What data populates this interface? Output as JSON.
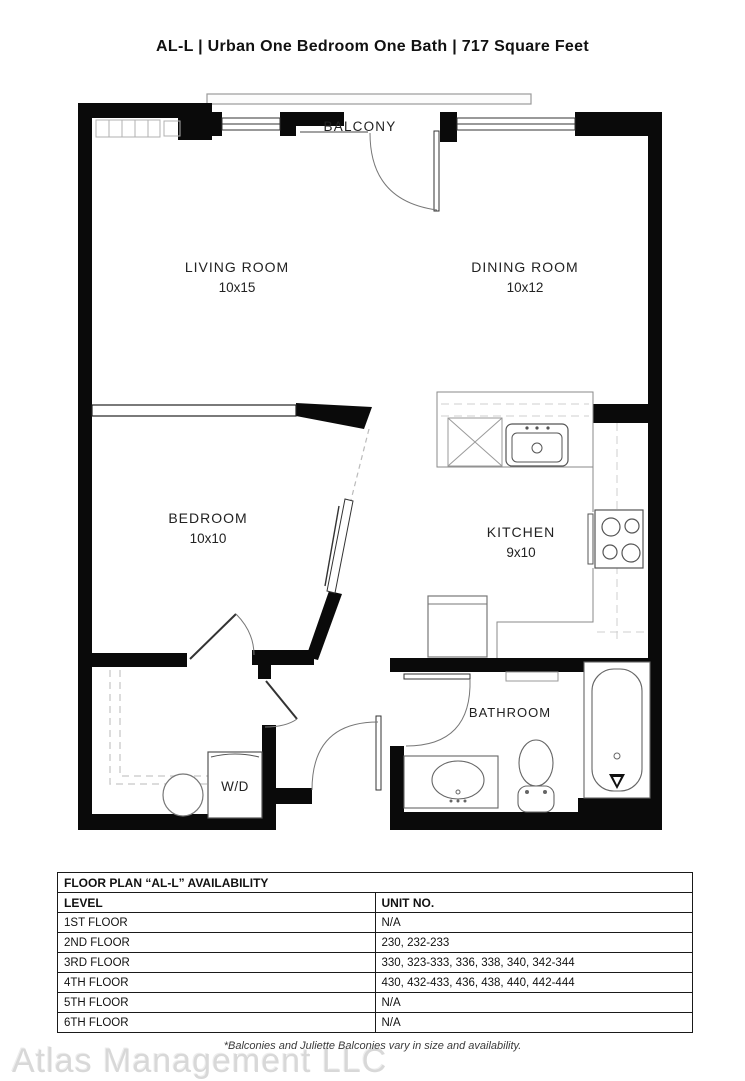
{
  "title": "AL-L | Urban One Bedroom One Bath | 717  Square Feet",
  "floor_plan": {
    "balcony_label": "BALCONY",
    "rooms": {
      "living": {
        "name": "LIVING ROOM",
        "dims": "10x15"
      },
      "dining": {
        "name": "DINING ROOM",
        "dims": "10x12"
      },
      "bedroom": {
        "name": "BEDROOM",
        "dims": "10x10"
      },
      "kitchen": {
        "name": "KITCHEN",
        "dims": "9x10"
      },
      "bathroom": {
        "name": "BATHROOM"
      },
      "laundry": {
        "name": "W/D"
      }
    }
  },
  "availability_table": {
    "title": "FLOOR PLAN “AL-L” AVAILABILITY",
    "columns": {
      "level": "LEVEL",
      "unit": "UNIT NO."
    },
    "rows": [
      {
        "level": "1ST FLOOR",
        "unit": "N/A"
      },
      {
        "level": "2ND FLOOR",
        "unit": "230, 232-233"
      },
      {
        "level": "3RD FLOOR",
        "unit": "330, 323-333, 336, 338, 340, 342-344"
      },
      {
        "level": "4TH FLOOR",
        "unit": "430, 432-433, 436, 438, 440, 442-444"
      },
      {
        "level": "5TH FLOOR",
        "unit": "N/A"
      },
      {
        "level": "6TH FLOOR",
        "unit": "N/A"
      }
    ]
  },
  "footer": {
    "note": "*Balconies and Juliette Balconies vary in size and availability.",
    "watermark": "Atlas Management LLC"
  },
  "colors": {
    "wall": "#0a0a0a",
    "fixture": "#666666",
    "light": "#c8c8c8"
  }
}
